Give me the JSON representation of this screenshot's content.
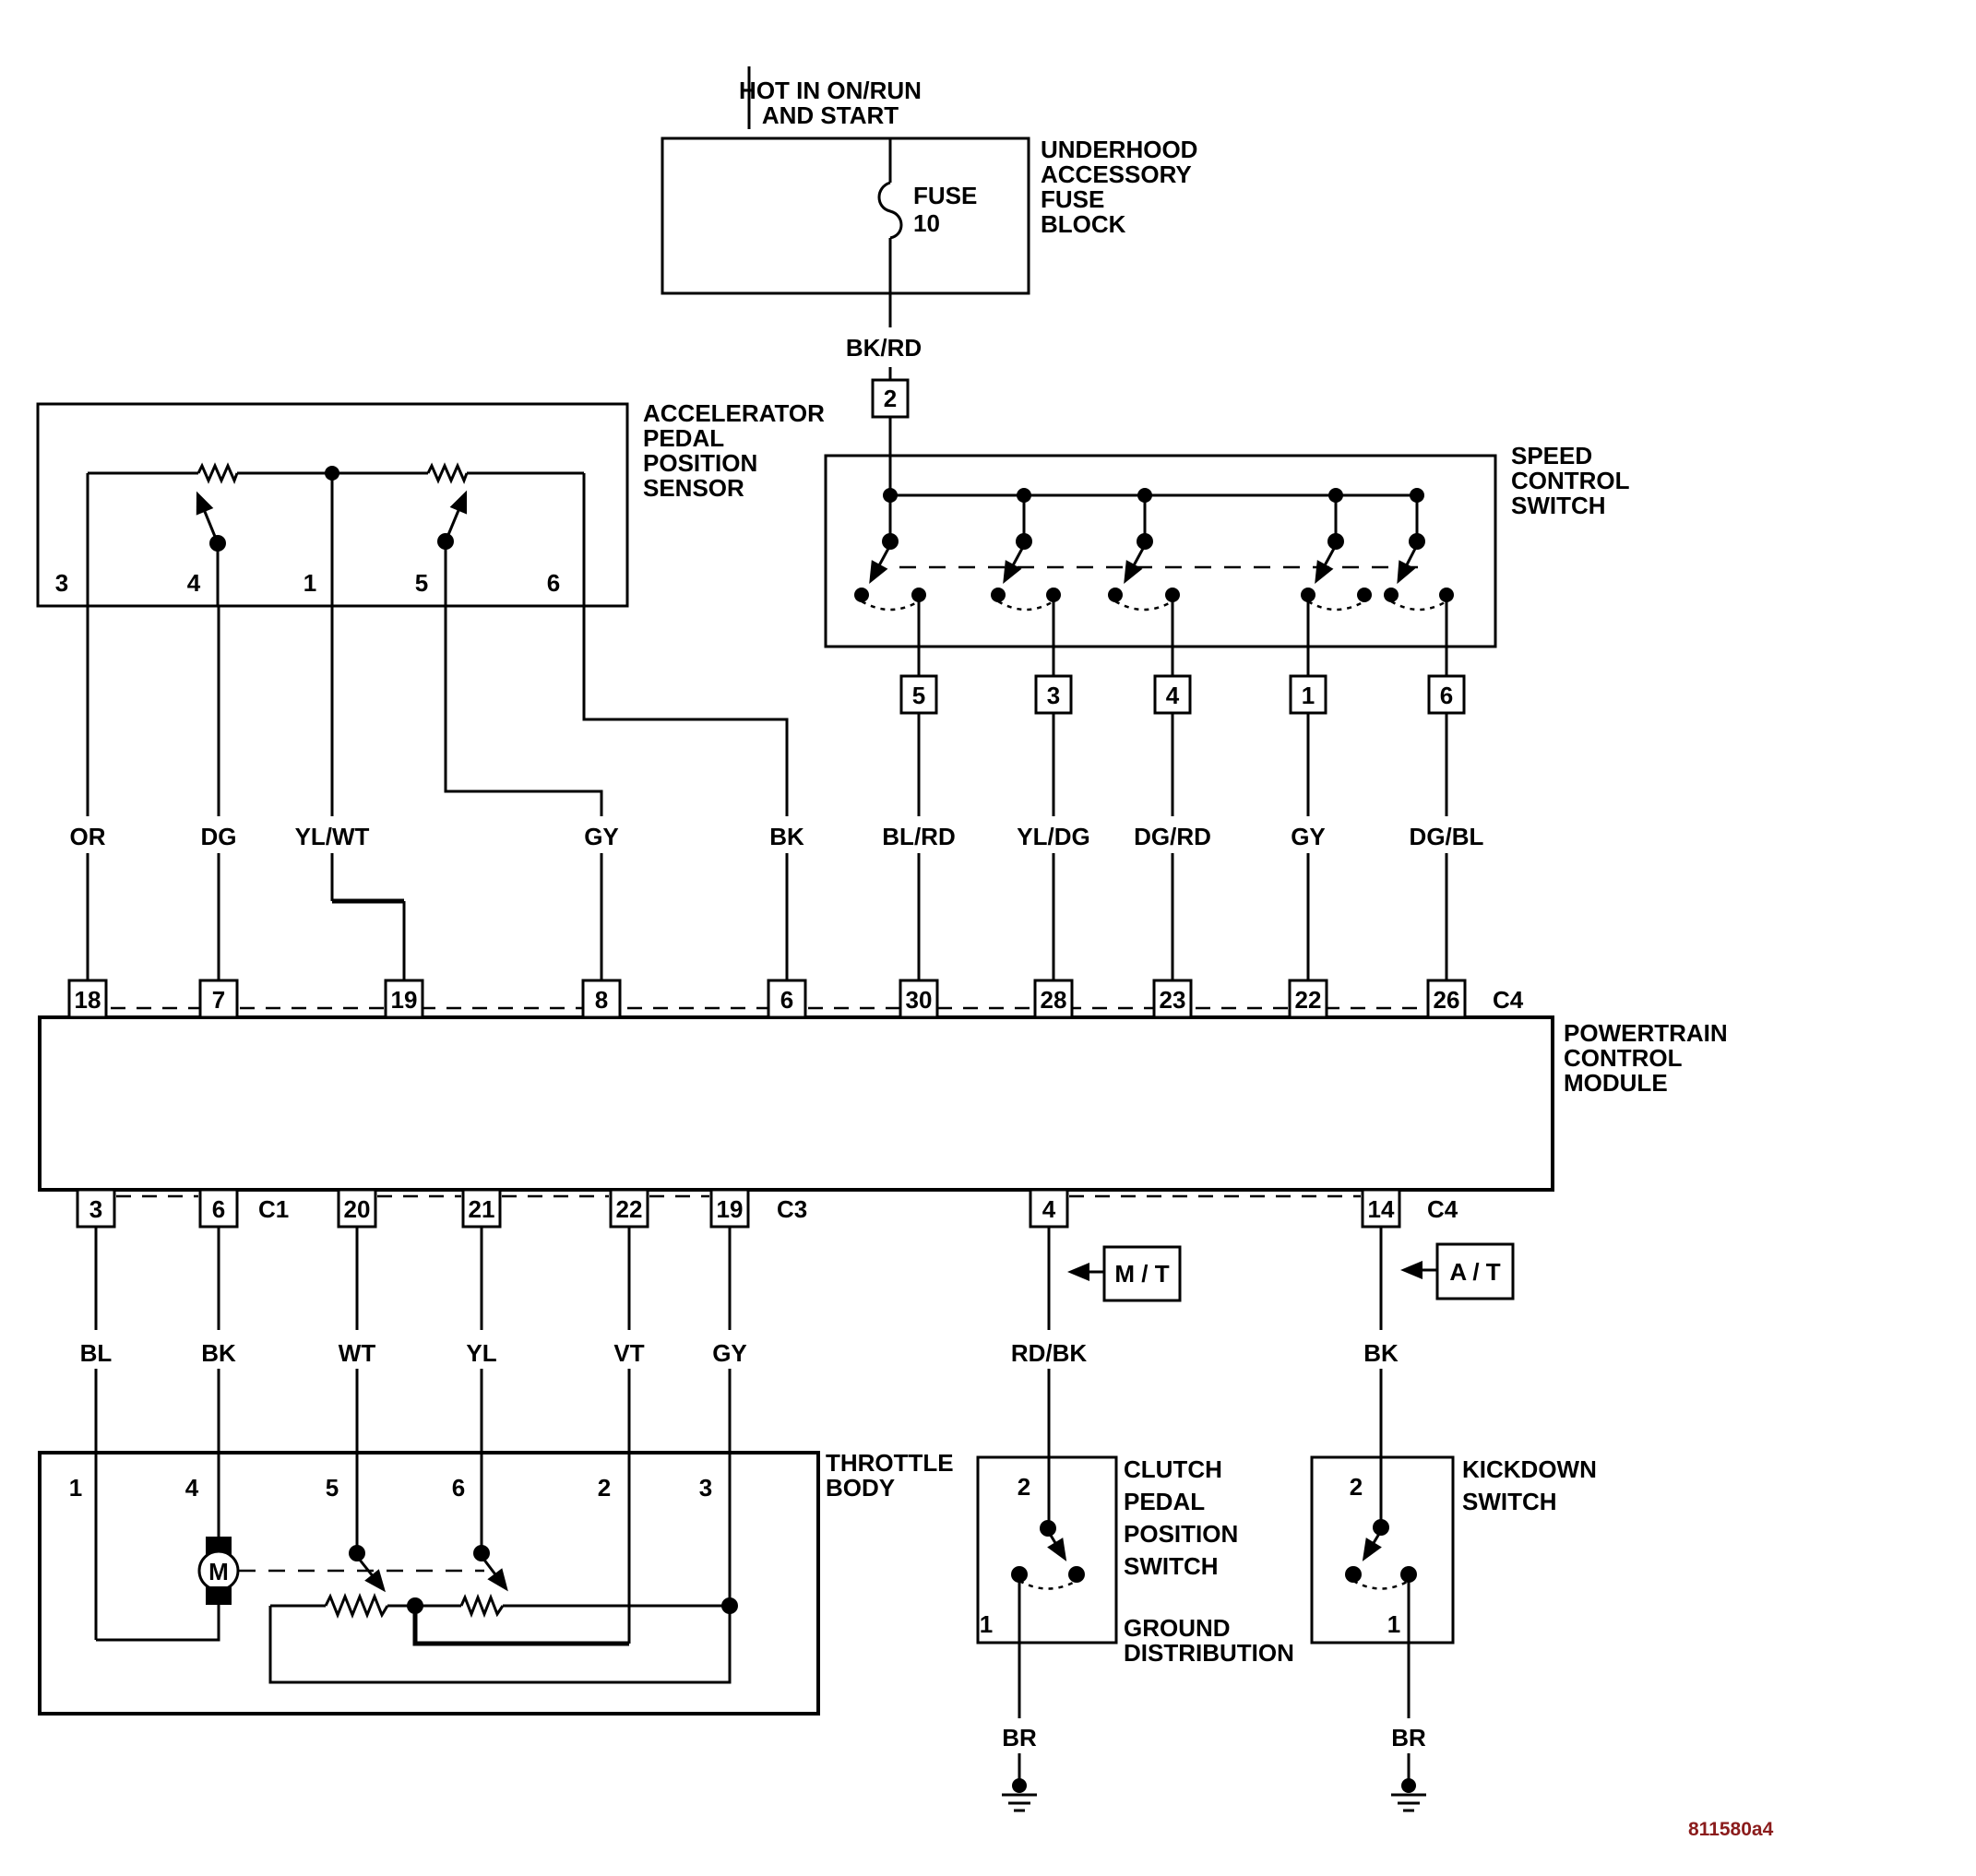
{
  "page": {
    "background": "#ffffff",
    "ink": "#000000"
  },
  "footer": {
    "code": "811580a4",
    "code_color": "#8b1c1c"
  },
  "power_feed": {
    "lines": [
      "HOT IN ON/RUN",
      "AND START"
    ]
  },
  "fuse_block": {
    "name_lines": [
      "UNDERHOOD",
      "ACCESSORY",
      "FUSE",
      "BLOCK"
    ],
    "fuse_name": "FUSE",
    "fuse_number": "10",
    "output_pin": "2",
    "output_wire": "BK/RD"
  },
  "accelerator_sensor": {
    "name_lines": [
      "ACCELERATOR",
      "PEDAL",
      "POSITION",
      "SENSOR"
    ],
    "pins": [
      "3",
      "4",
      "1",
      "5",
      "6"
    ]
  },
  "speed_control_switch": {
    "name_lines": [
      "SPEED",
      "CONTROL",
      "SWITCH"
    ],
    "connector_pins": [
      "5",
      "3",
      "4",
      "1",
      "6"
    ]
  },
  "wires_to_pcm_top": {
    "labels": [
      "OR",
      "DG",
      "YL/WT",
      "GY",
      "BK",
      "BL/RD",
      "YL/DG",
      "DG/RD",
      "GY",
      "DG/BL"
    ]
  },
  "pcm": {
    "name_lines": [
      "POWERTRAIN",
      "CONTROL",
      "MODULE"
    ],
    "top_pins": [
      "18",
      "7",
      "19",
      "8",
      "6",
      "30",
      "28",
      "23",
      "22",
      "26"
    ],
    "top_connector": "C4",
    "bottom_pins": [
      "3",
      "6",
      "20",
      "21",
      "22",
      "19",
      "4",
      "14"
    ],
    "bottom_connector_c1": "C1",
    "bottom_connector_c3": "C3",
    "bottom_connector_c4": "C4"
  },
  "wires_from_pcm_bottom": {
    "labels": [
      "BL",
      "BK",
      "WT",
      "YL",
      "VT",
      "GY",
      "RD/BK",
      "BK"
    ]
  },
  "transmission_tags": {
    "manual": "M / T",
    "automatic": "A / T"
  },
  "throttle_body": {
    "name_lines": [
      "THROTTLE",
      "BODY"
    ],
    "pins": [
      "1",
      "4",
      "5",
      "6",
      "2",
      "3"
    ],
    "motor": "M"
  },
  "clutch_switch": {
    "name_lines": [
      "CLUTCH",
      "PEDAL",
      "POSITION",
      "SWITCH"
    ],
    "pin_top": "2",
    "pin_bottom": "1",
    "ground_wire": "BR"
  },
  "kickdown_switch": {
    "name_lines": [
      "KICKDOWN",
      "SWITCH"
    ],
    "pin_top": "2",
    "pin_bottom": "1",
    "ground_wire": "BR"
  },
  "ground_distribution": {
    "name_lines": [
      "GROUND",
      "DISTRIBUTION"
    ]
  }
}
